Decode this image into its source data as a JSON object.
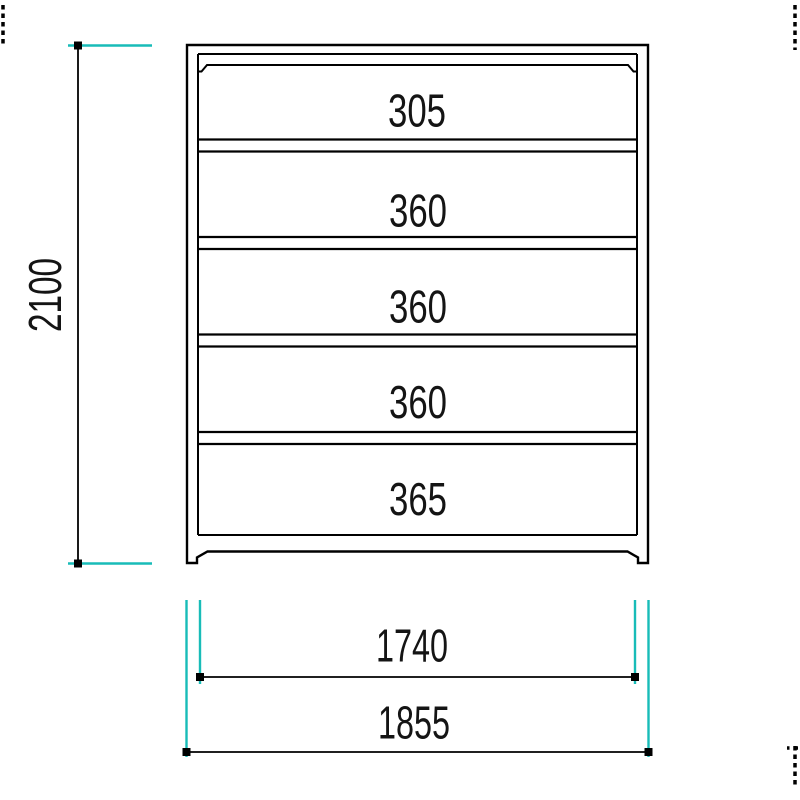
{
  "drawing": {
    "kind": "cabinet-elevation",
    "colors": {
      "line": "#000000",
      "extension": "#18bcb8",
      "text": "#141414",
      "background": "#ffffff"
    },
    "cabinet": {
      "compartments": [
        {
          "label": "305"
        },
        {
          "label": "360"
        },
        {
          "label": "360"
        },
        {
          "label": "360"
        },
        {
          "label": "365"
        }
      ]
    },
    "dimensions": {
      "overall_height": {
        "label": "2100",
        "orientation": "vertical"
      },
      "inner_width": {
        "label": "1740",
        "orientation": "horizontal"
      },
      "overall_width": {
        "label": "1855",
        "orientation": "horizontal"
      }
    }
  }
}
